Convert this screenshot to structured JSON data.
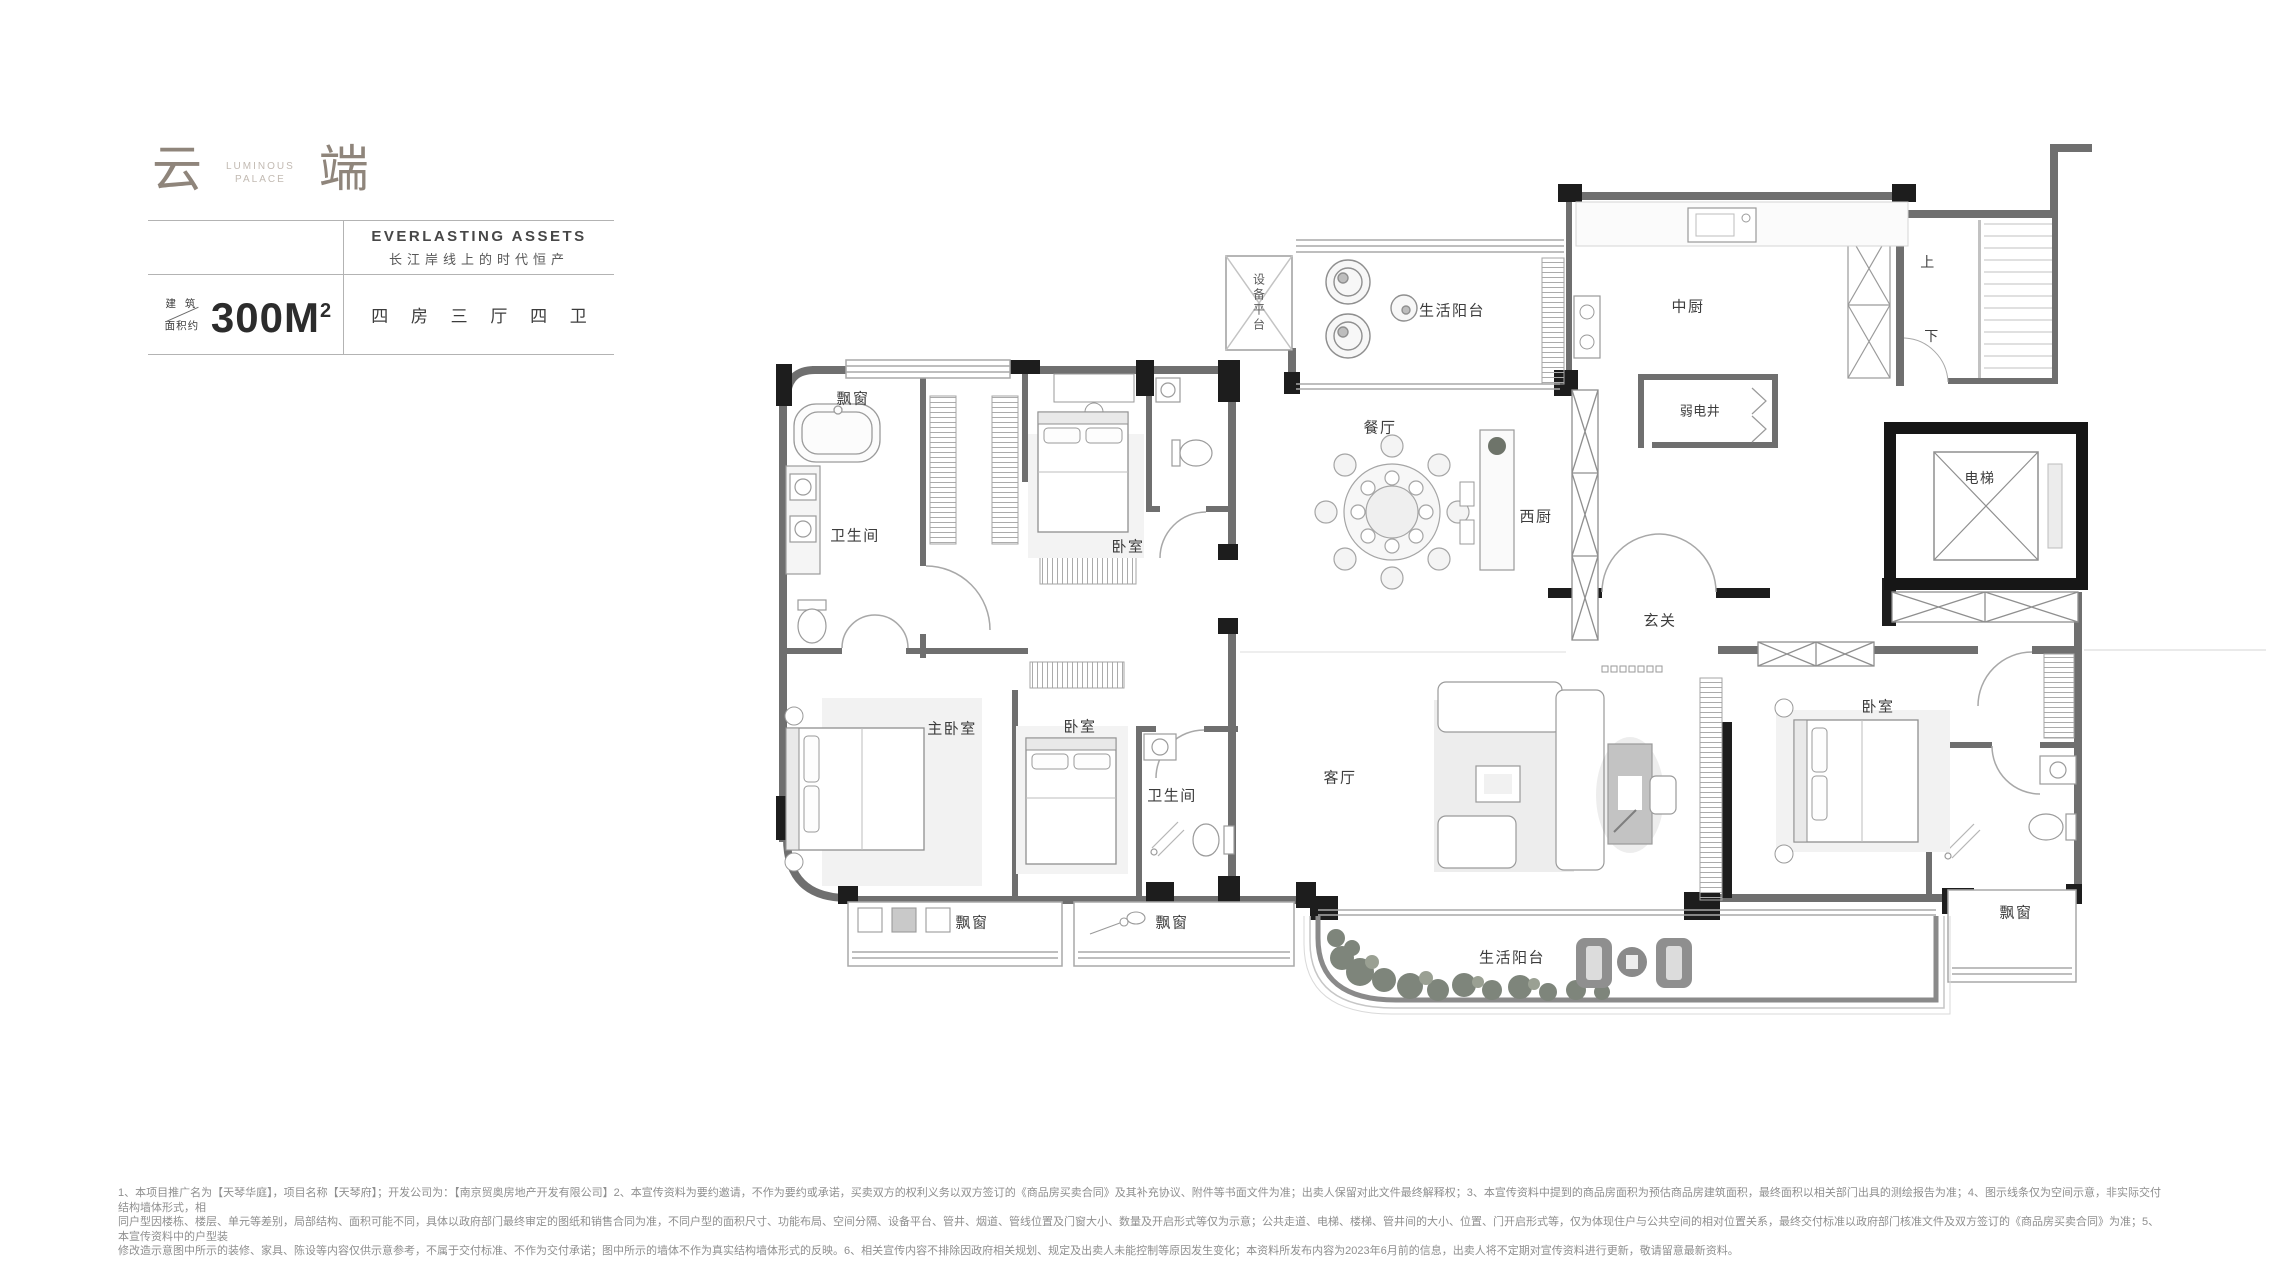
{
  "header": {
    "brand": {
      "char_left": "云",
      "char_right": "端",
      "sub_top": "LUMINOUS",
      "sub_bottom": "PALACE"
    },
    "tagline_en": "EVERLASTING ASSETS",
    "tagline_cn": "长江岸线上的时代恒产",
    "area": {
      "prefix_top": "建 筑",
      "prefix_bottom": "面积约",
      "value": "300M",
      "sup": "2"
    },
    "layout": "四 房 三 厅 四 卫"
  },
  "floorplan": {
    "rooms": [
      {
        "id": "equipment-platform",
        "label": "设备平台"
      },
      {
        "id": "service-balcony-top",
        "label": "生活阳台"
      },
      {
        "id": "chinese-kitchen",
        "label": "中厨"
      },
      {
        "id": "stairs-up",
        "label": "上"
      },
      {
        "id": "stairs-down",
        "label": "下"
      },
      {
        "id": "utility-shaft",
        "label": "弱电井"
      },
      {
        "id": "dining-room",
        "label": "餐厅"
      },
      {
        "id": "western-kitchen",
        "label": "西厨"
      },
      {
        "id": "elevator",
        "label": "电梯"
      },
      {
        "id": "foyer",
        "label": "玄关"
      },
      {
        "id": "bay-window-top-left",
        "label": "飘窗"
      },
      {
        "id": "bathroom-master",
        "label": "卫生间"
      },
      {
        "id": "bedroom-north",
        "label": "卧室"
      },
      {
        "id": "master-bedroom",
        "label": "主卧室"
      },
      {
        "id": "bedroom-west",
        "label": "卧室"
      },
      {
        "id": "bathroom-middle",
        "label": "卫生间"
      },
      {
        "id": "living-room",
        "label": "客厅"
      },
      {
        "id": "bedroom-east",
        "label": "卧室"
      },
      {
        "id": "bay-window-master",
        "label": "飘窗"
      },
      {
        "id": "bay-window-west",
        "label": "飘窗"
      },
      {
        "id": "bay-window-east",
        "label": "飘窗"
      },
      {
        "id": "service-balcony-bottom",
        "label": "生活阳台"
      }
    ]
  },
  "disclaimer": {
    "lines": [
      "1、本项目推广名为【天琴华庭】，项目名称【天琴府】；开发公司为：【南京贸奥房地产开发有限公司】2、本宣传资料为要约邀请，不作为要约或承诺，买卖双方的权利义务以双方签订的《商品房买卖合同》及其补充协议、附件等书面文件为准；出卖人保留对此文件最终解释权；3、本宣传资料中提到的商品房面积为预估商品房建筑面积，最终面积以相关部门出具的测绘报告为准；4、图示线条仅为空间示意，非实际交付结构墙体形式，相",
      "同户型因楼栋、楼层、单元等差别，局部结构、面积可能不同，具体以政府部门最终审定的图纸和销售合同为准，不同户型的面积尺寸、功能布局、空间分隔、设备平台、管井、烟道、管线位置及门窗大小、数量及开启形式等仅为示意；公共走道、电梯、楼梯、管井间的大小、位置、门开启形式等，仅为体现住户与公共空间的相对位置关系，最终交付标准以政府部门核准文件及双方签订的《商品房买卖合同》为准；5、本宣传资料中的户型装",
      "修改造示意图中所示的装修、家具、陈设等内容仅供示意参考，不属于交付标准、不作为交付承诺；图中所示的墙体不作为真实结构墙体形式的反映。6、相关宣传内容不排除因政府相关规划、规定及出卖人未能控制等原因发生变化；本资料所发布内容为2023年6月前的信息，出卖人将不定期对宣传资料进行更新，敬请留意最新资料。"
    ]
  },
  "colors": {
    "brand": "#8f857b",
    "wall": "#6f6f6f",
    "wall_dark": "#1d1d1d",
    "label": "#3d3d3d",
    "line": "#b3b3b3"
  }
}
